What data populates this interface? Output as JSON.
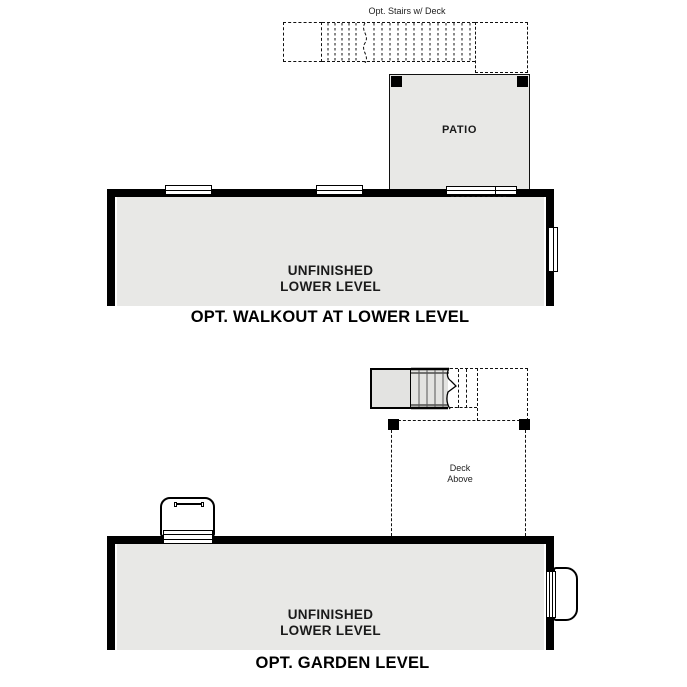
{
  "walkout_plan": {
    "stairs_label": "Opt. Stairs w/ Deck",
    "patio_label": "PATIO",
    "room_label": [
      "UNFINISHED",
      "LOWER LEVEL"
    ],
    "title": "OPT. WALKOUT AT LOWER LEVEL"
  },
  "garden_plan": {
    "deck_label": [
      "Deck",
      "Above"
    ],
    "room_label": [
      "UNFINISHED",
      "LOWER LEVEL"
    ],
    "title": "OPT. GARDEN LEVEL"
  },
  "colors": {
    "floor_fill": "#e8e8e6",
    "stair_fill": "#e3e3e1",
    "wall": "#000000",
    "dashed_line": "#111111",
    "background": "#ffffff"
  }
}
